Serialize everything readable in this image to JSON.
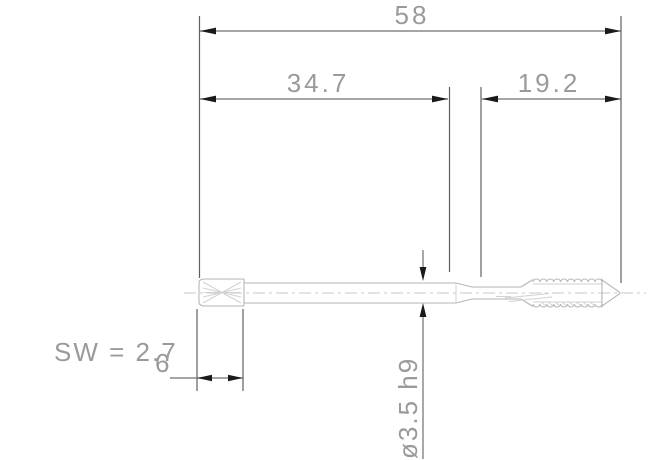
{
  "drawing": {
    "type": "technical-dimension-drawing",
    "subject": "machine-tap-side-view",
    "dimensions": {
      "overall_length": "58",
      "front_length": "34.7",
      "thread_length": "19.2",
      "shank_diameter": "ø3.5 h9",
      "square_note": "SW = 2.7",
      "square_length": "6"
    },
    "colors": {
      "background": "#ffffff",
      "tool_outline": "#b6b6b6",
      "tool_detail": "#d2d2d2",
      "centerline": "#c9c9c9",
      "dimension_line": "#6f6f6f",
      "extension_line": "#606060",
      "arrow": "#1a1a1a",
      "text": "#9a9a9a"
    }
  }
}
